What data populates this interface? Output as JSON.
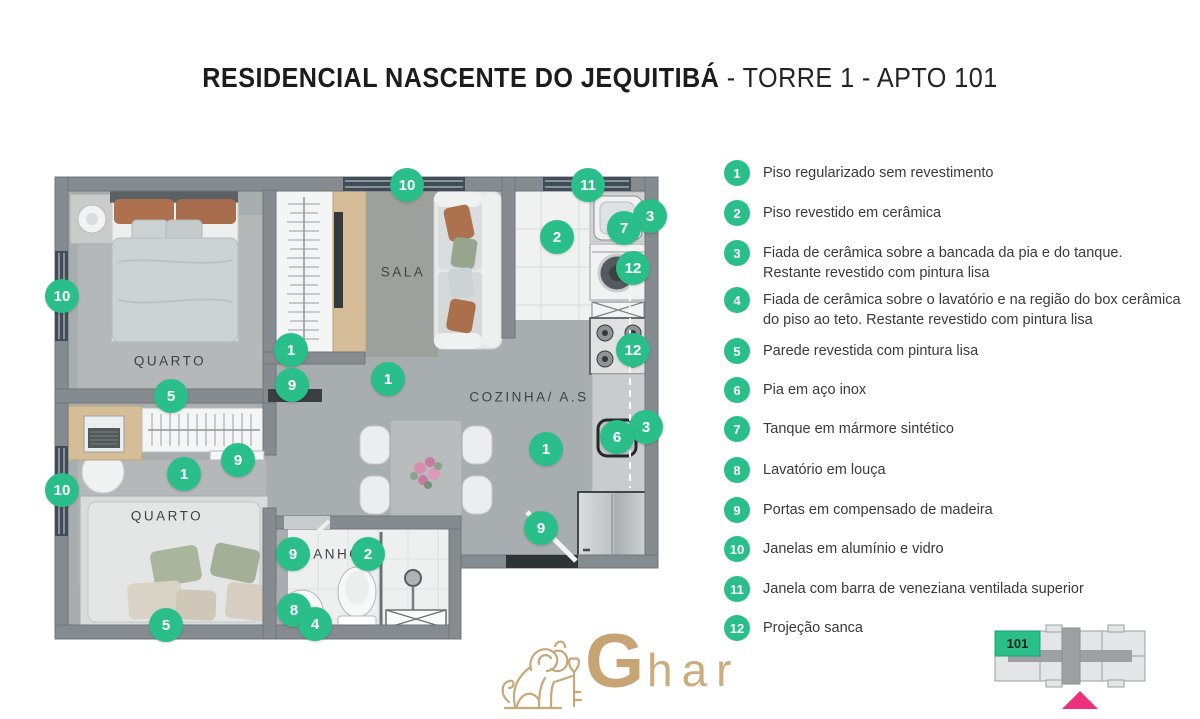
{
  "title": {
    "project": "RESIDENCIAL NASCENTE DO JEQUITIBÁ",
    "unit": " - TORRE 1 - APTO 101"
  },
  "colors": {
    "marker_green": "#2abe8a",
    "keyplan_highlight": "#2abe8a",
    "keyplan_arrow_pink": "#ee2f7d",
    "logo_gold": "#c6a473"
  },
  "plan": {
    "rooms": [
      {
        "label": "QUARTO"
      },
      {
        "label": "SALA"
      },
      {
        "label": "COZINHA/ A.S"
      },
      {
        "label": "QUARTO"
      },
      {
        "label": "BANHO"
      }
    ],
    "markers": [
      {
        "n": "10",
        "x": 407,
        "y": 185
      },
      {
        "n": "11",
        "x": 588,
        "y": 185
      },
      {
        "n": "3",
        "x": 650,
        "y": 216
      },
      {
        "n": "7",
        "x": 624,
        "y": 228
      },
      {
        "n": "2",
        "x": 557,
        "y": 237
      },
      {
        "n": "12",
        "x": 633,
        "y": 268
      },
      {
        "n": "10",
        "x": 62,
        "y": 296
      },
      {
        "n": "1",
        "x": 291,
        "y": 350
      },
      {
        "n": "12",
        "x": 633,
        "y": 350
      },
      {
        "n": "1",
        "x": 388,
        "y": 379
      },
      {
        "n": "9",
        "x": 292,
        "y": 385
      },
      {
        "n": "5",
        "x": 171,
        "y": 396
      },
      {
        "n": "3",
        "x": 646,
        "y": 427
      },
      {
        "n": "6",
        "x": 617,
        "y": 437
      },
      {
        "n": "1",
        "x": 546,
        "y": 449
      },
      {
        "n": "9",
        "x": 238,
        "y": 460
      },
      {
        "n": "1",
        "x": 184,
        "y": 474
      },
      {
        "n": "10",
        "x": 62,
        "y": 490
      },
      {
        "n": "9",
        "x": 541,
        "y": 528
      },
      {
        "n": "9",
        "x": 293,
        "y": 554
      },
      {
        "n": "2",
        "x": 368,
        "y": 554
      },
      {
        "n": "8",
        "x": 294,
        "y": 610
      },
      {
        "n": "4",
        "x": 315,
        "y": 624
      },
      {
        "n": "5",
        "x": 166,
        "y": 625
      }
    ]
  },
  "legend": {
    "items": [
      {
        "n": "1",
        "text": "Piso regularizado sem revestimento"
      },
      {
        "n": "2",
        "text": "Piso revestido em cerâmica"
      },
      {
        "n": "3",
        "text": "Fiada de cerâmica sobre a bancada da pia e do tanque. Restante revestido com pintura lisa"
      },
      {
        "n": "4",
        "text": "Fiada de cerâmica sobre o lavatório e na região do box cerâmica do piso ao teto. Restante revestido com pintura lisa"
      },
      {
        "n": "5",
        "text": "Parede revestida com pintura lisa"
      },
      {
        "n": "6",
        "text": "Pia em aço inox"
      },
      {
        "n": "7",
        "text": "Tanque em mármore sintético"
      },
      {
        "n": "8",
        "text": "Lavatório em louça"
      },
      {
        "n": "9",
        "text": "Portas em compensado de madeira"
      },
      {
        "n": "10",
        "text": "Janelas em alumínio e vidro"
      },
      {
        "n": "11",
        "text": "Janela com barra de veneziana ventilada superior"
      },
      {
        "n": "12",
        "text": "Projeção sanca"
      }
    ]
  },
  "keyplan": {
    "unit_label": "101"
  },
  "logo": {
    "text_g": "G",
    "text_rest": "har"
  }
}
